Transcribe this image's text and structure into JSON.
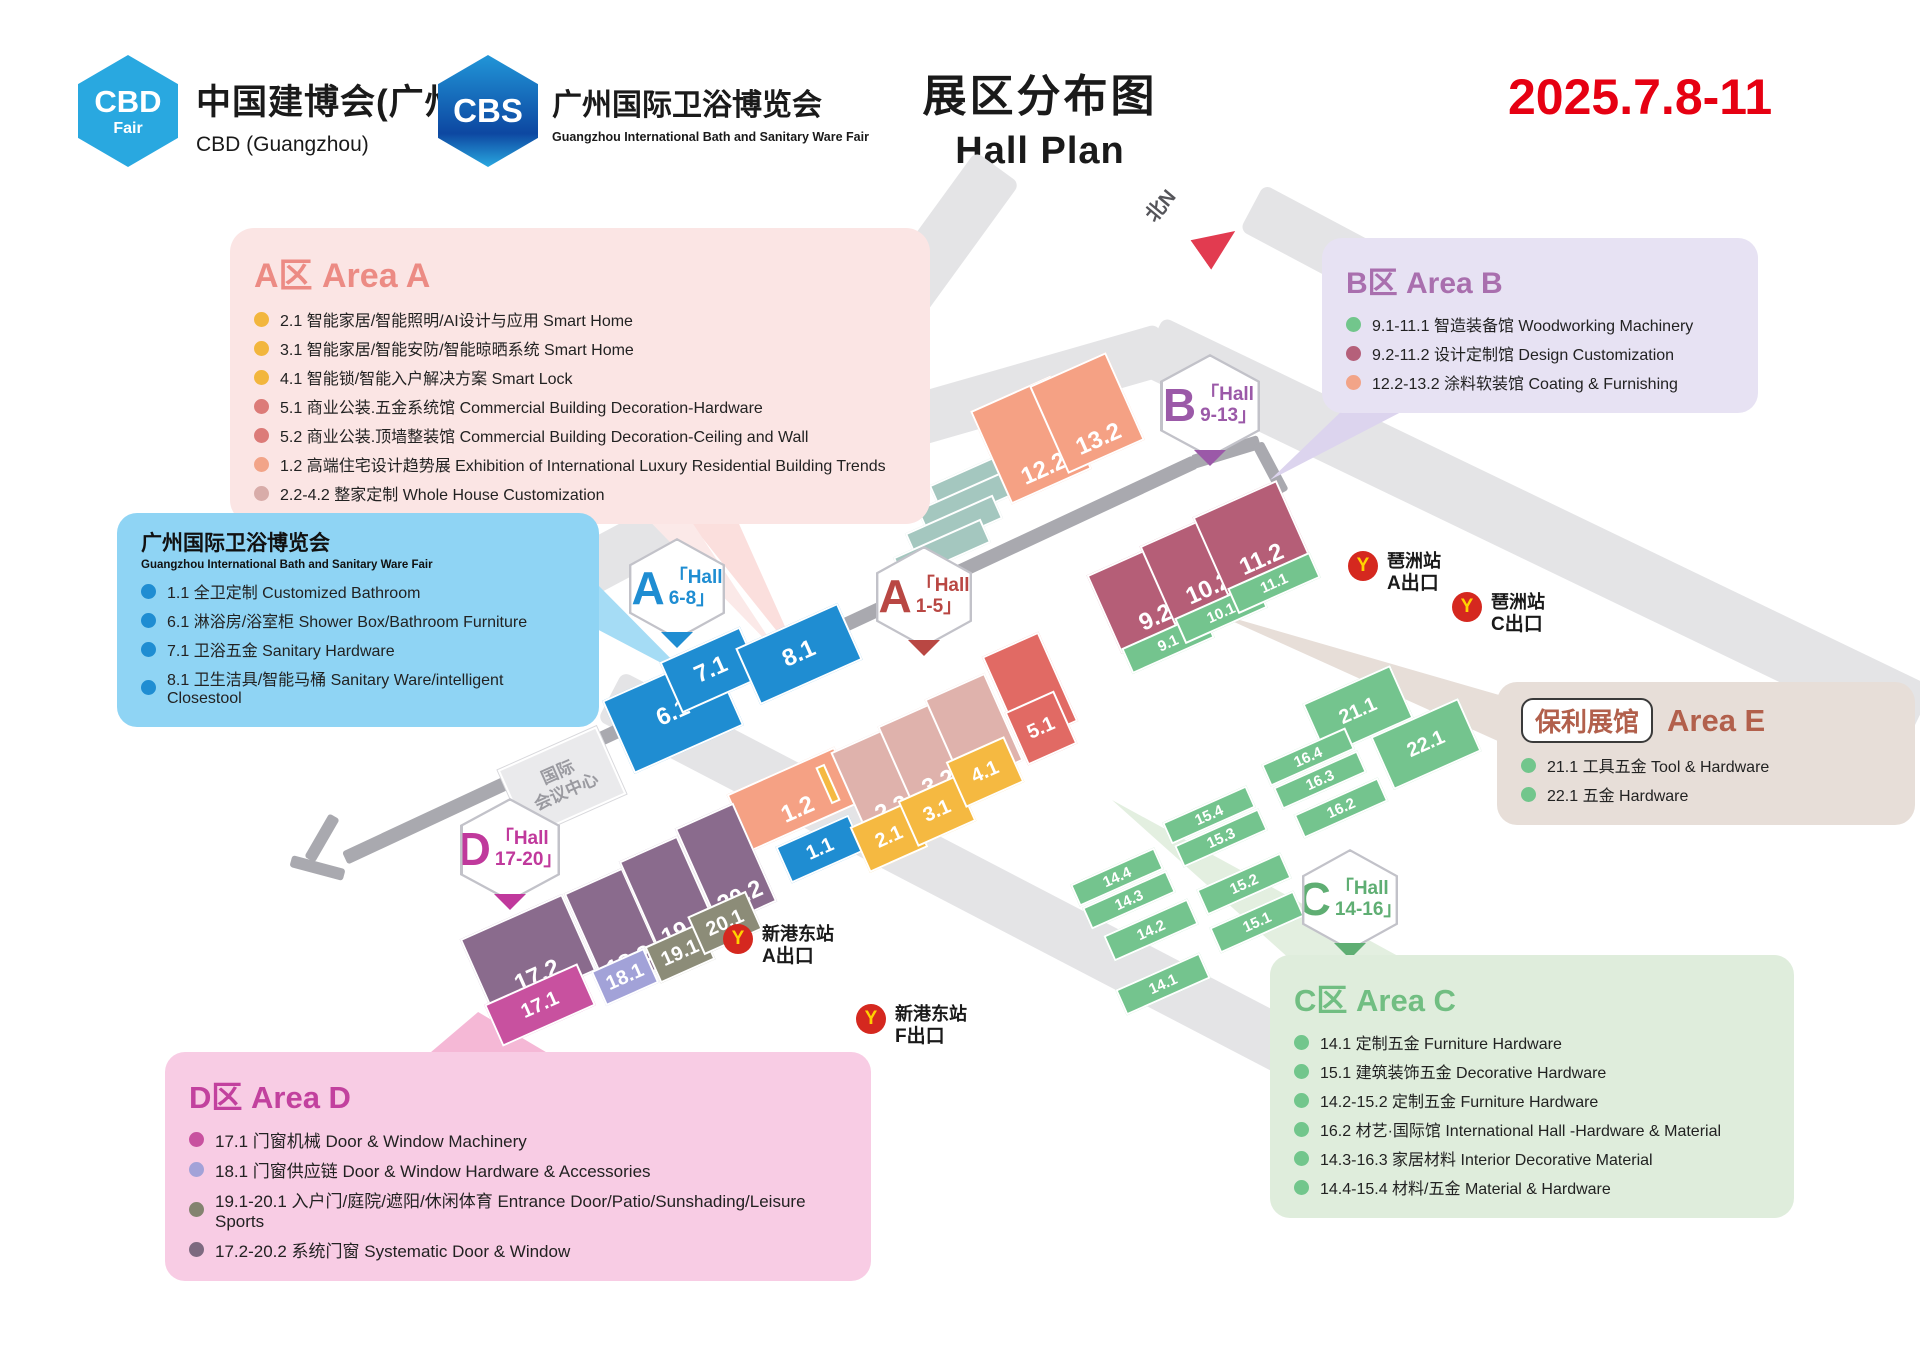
{
  "header": {
    "logo1": {
      "badge": "CBD",
      "badge_sub": "Fair",
      "title": "中国建博会(广州)",
      "subtitle": "CBD (Guangzhou)"
    },
    "logo2": {
      "badge": "CBS",
      "title": "广州国际卫浴博览会",
      "subtitle": "Guangzhou International Bath and Sanitary Ware Fair"
    },
    "title_cn": "展区分布图",
    "title_en": "Hall Plan",
    "date": "2025.7.8-11"
  },
  "legend_a": {
    "title": "A区 Area A",
    "items": [
      "2.1 智能家居/智能照明/AI设计与应用 Smart Home",
      "3.1 智能家居/智能安防/智能晾晒系统 Smart Home",
      "4.1 智能锁/智能入户解决方案 Smart Lock",
      "5.1 商业公装.五金系统馆 Commercial Building Decoration-Hardware",
      "5.2 商业公装.顶墙整装馆 Commercial Building Decoration-Ceiling and Wall",
      "1.2 高端住宅设计趋势展 Exhibition of International Luxury Residential Building Trends",
      "2.2-4.2 整家定制 Whole House Customization"
    ]
  },
  "legend_bath": {
    "title": "广州国际卫浴博览会",
    "subtitle": "Guangzhou International Bath and Sanitary Ware Fair",
    "items": [
      "1.1 全卫定制 Customized Bathroom",
      "6.1 淋浴房/浴室柜 Shower Box/Bathroom Furniture",
      "7.1 卫浴五金 Sanitary Hardware",
      "8.1 卫生洁具/智能马桶 Sanitary Ware/intelligent Closestool"
    ]
  },
  "legend_b": {
    "title": "B区 Area B",
    "items": [
      "9.1-11.1 智造装备馆 Woodworking Machinery",
      "9.2-11.2 设计定制馆 Design Customization",
      "12.2-13.2 涂料软装馆 Coating & Furnishing"
    ]
  },
  "legend_e": {
    "pill": "保利展馆",
    "title": "Area E",
    "items": [
      "21.1 工具五金 Tool & Hardware",
      "22.1 五金 Hardware"
    ]
  },
  "legend_c": {
    "title": "C区 Area C",
    "items": [
      "14.1 定制五金 Furniture Hardware",
      "15.1 建筑装饰五金 Decorative Hardware",
      "14.2-15.2 定制五金 Furniture Hardware",
      "16.2 材艺·国际馆 International Hall -Hardware & Material",
      "14.3-16.3 家居材料 Interior Decorative Material",
      "14.4-15.4 材料/五金 Material & Hardware"
    ]
  },
  "legend_d": {
    "title": "D区 Area D",
    "items": [
      "17.1 门窗机械 Door & Window Machinery",
      "18.1 门窗供应链 Door & Window Hardware & Accessories",
      "19.1-20.1 入户门/庭院/遮阳/休闲体育 Entrance Door/Patio/Sunshading/Leisure Sports",
      "17.2-20.2 系统门窗 Systematic Door & Window"
    ]
  },
  "map": {
    "compass": "北N",
    "center_line1": "国际",
    "center_line2": "会议中心",
    "badges": {
      "a68": {
        "letter": "A",
        "line1": "「Hall",
        "line2": "6-8」"
      },
      "a15": {
        "letter": "A",
        "line1": "「Hall",
        "line2": "1-5」"
      },
      "b913": {
        "letter": "B",
        "line1": "「Hall",
        "line2": "9-13」"
      },
      "c1416": {
        "letter": "C",
        "line1": "「Hall",
        "line2": "14-16」"
      },
      "d1720": {
        "letter": "D",
        "line1": "「Hall",
        "line2": "17-20」"
      }
    },
    "stations": [
      {
        "name": "琶洲站",
        "exit": "A出口"
      },
      {
        "name": "琶洲站",
        "exit": "C出口"
      },
      {
        "name": "新港东站",
        "exit": "A出口"
      },
      {
        "name": "新港东站",
        "exit": "F出口"
      }
    ],
    "halls": {
      "h1_1": "1.1",
      "h1_2": "1.2",
      "h2_1": "2.1",
      "h2_2": "2.2",
      "h3_1": "3.1",
      "h3_2": "3.2",
      "h4_1": "4.1",
      "h4_2": "4.2",
      "h5_1": "5.1",
      "h5_2": "5.2",
      "h6_1": "6.1",
      "h7_1": "7.1",
      "h8_1": "8.1",
      "h9_1": "9.1",
      "h9_2": "9.2",
      "h10_1": "10.1",
      "h10_2": "10.2",
      "h11_1": "11.1",
      "h11_2": "11.2",
      "h12_2": "12.2",
      "h13_2": "13.2",
      "h14_1": "14.1",
      "h14_2": "14.2",
      "h14_3": "14.3",
      "h14_4": "14.4",
      "h15_1": "15.1",
      "h15_2": "15.2",
      "h15_3": "15.3",
      "h15_4": "15.4",
      "h16_2": "16.2",
      "h16_3": "16.3",
      "h16_4": "16.4",
      "h17_1": "17.1",
      "h17_2": "17.2",
      "h18_1": "18.1",
      "h18_2": "18.2",
      "h19_1": "19.1",
      "h19_2": "19.2",
      "h20_1": "20.1",
      "h20_2": "20.2",
      "h21_1": "21.1",
      "h22_1": "22.1"
    }
  },
  "colors": {
    "date_red": "#E60012",
    "blue": "#1F8DD2",
    "salmon": "#F5A184",
    "rose": "#DFB2AC",
    "red": "#E16A64",
    "yellow": "#F5B941",
    "maroon": "#B55E77",
    "green": "#74C48E",
    "mauve": "#8A6B8D",
    "magenta": "#C8519F",
    "periwinkle": "#A2A2D8",
    "olive": "#8C8C78",
    "area_a_accent": "#EC8B84",
    "area_b_accent": "#A96FAE",
    "area_c_accent": "#71BE82",
    "area_d_accent": "#C2419E",
    "area_e_accent": "#B2604C",
    "bath_box": "#8FD4F4"
  }
}
